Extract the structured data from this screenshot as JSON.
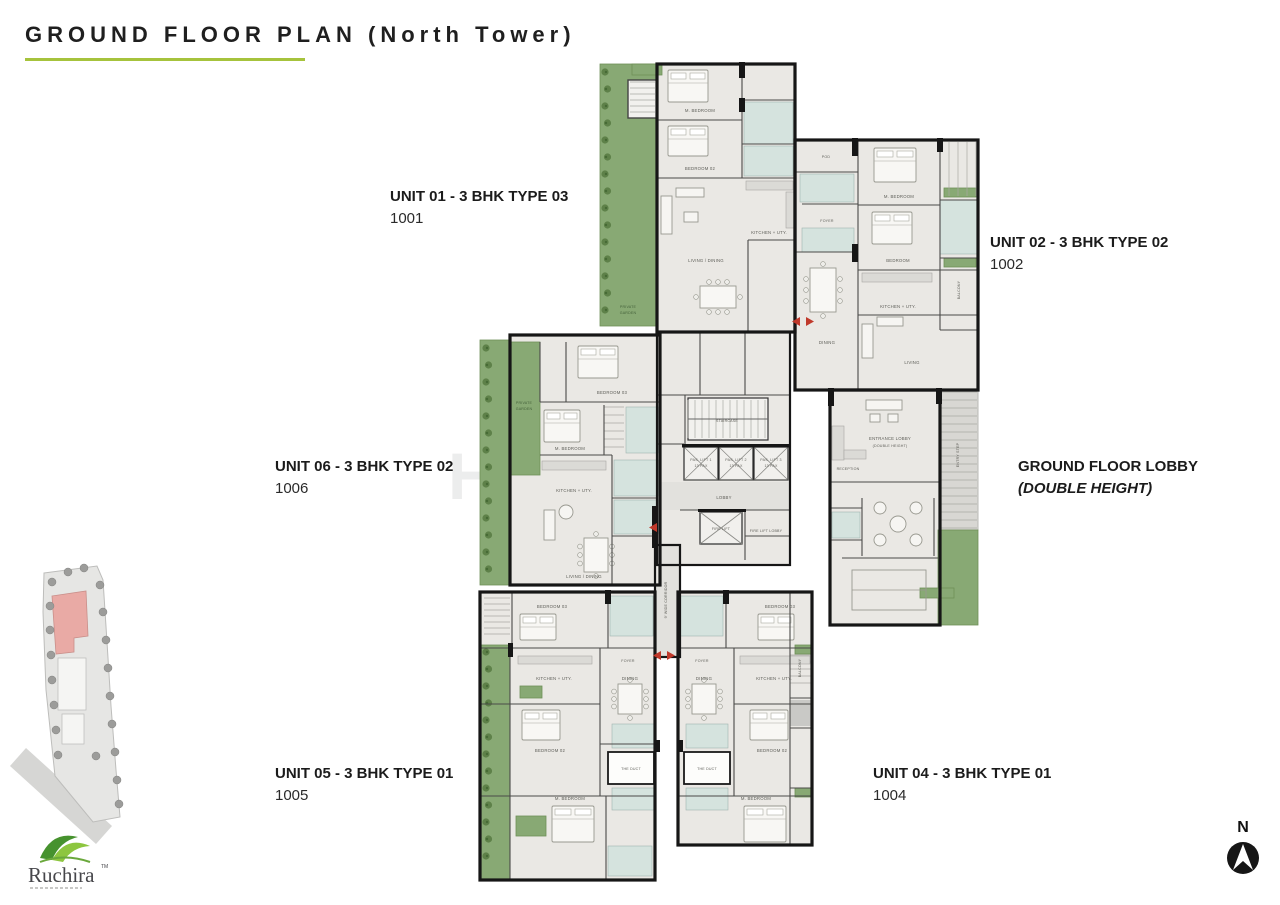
{
  "title": "GROUND FLOOR PLAN (North Tower)",
  "watermark": "Housing",
  "units": {
    "unit01": {
      "name": "UNIT 01 - 3 BHK TYPE 03",
      "number": "1001"
    },
    "unit02": {
      "name": "UNIT 02 - 3 BHK TYPE 02",
      "number": "1002"
    },
    "unit06": {
      "name": "UNIT 06 - 3 BHK TYPE 02",
      "number": "1006"
    },
    "lobby": {
      "name": "GROUND FLOOR LOBBY",
      "number": "(DOUBLE HEIGHT)"
    },
    "unit05": {
      "name": "UNIT 05 - 3 BHK TYPE 01",
      "number": "1005"
    },
    "unit04": {
      "name": "UNIT 04 - 3 BHK TYPE 01",
      "number": "1004"
    }
  },
  "plan": {
    "rooms": {
      "private1": "PRIVATE",
      "private2": "GARDEN",
      "m_bedroom": "M. BEDROOM",
      "bedroom": "BEDROOM",
      "bedroom02": "BEDROOM 02",
      "bedroom03": "BEDROOM 03",
      "living_dining": "LIVING / DINING",
      "living": "LIVING",
      "dining": "DINING",
      "kitchen": "KITCHEN + UTY.",
      "pod": "POD",
      "foyer": "FOYER",
      "balcony": "BALCONY",
      "staircase": "STAIRCASE",
      "lift1": "PAS. LIFT 1",
      "lift2": "PAS. LIFT 2",
      "lift3": "PAS. LIFT 3",
      "pax": "13 PAX",
      "lobby": "LOBBY",
      "fire_lift": "FIRE LIFT",
      "fire_lobby": "FIRE LIFT LOBBY",
      "corridor": "9' WIDE CORRIDOR",
      "entrance1": "ENTRANCE LOBBY",
      "entrance2": "(DOUBLE HEIGHT)",
      "reception": "RECEPTION",
      "entry_step": "ENTRY STEP",
      "duct": "THE DUCT"
    }
  },
  "compass": {
    "label": "N"
  },
  "logo": {
    "brand": "Ruchira",
    "tm": "TM"
  },
  "colors": {
    "accent_green": "#a6c33c",
    "plan_garden": "#88a974",
    "wall": "#161616",
    "toilet": "#d5e3de",
    "floor": "#eae8e4",
    "entry_arrow": "#c0392b"
  }
}
